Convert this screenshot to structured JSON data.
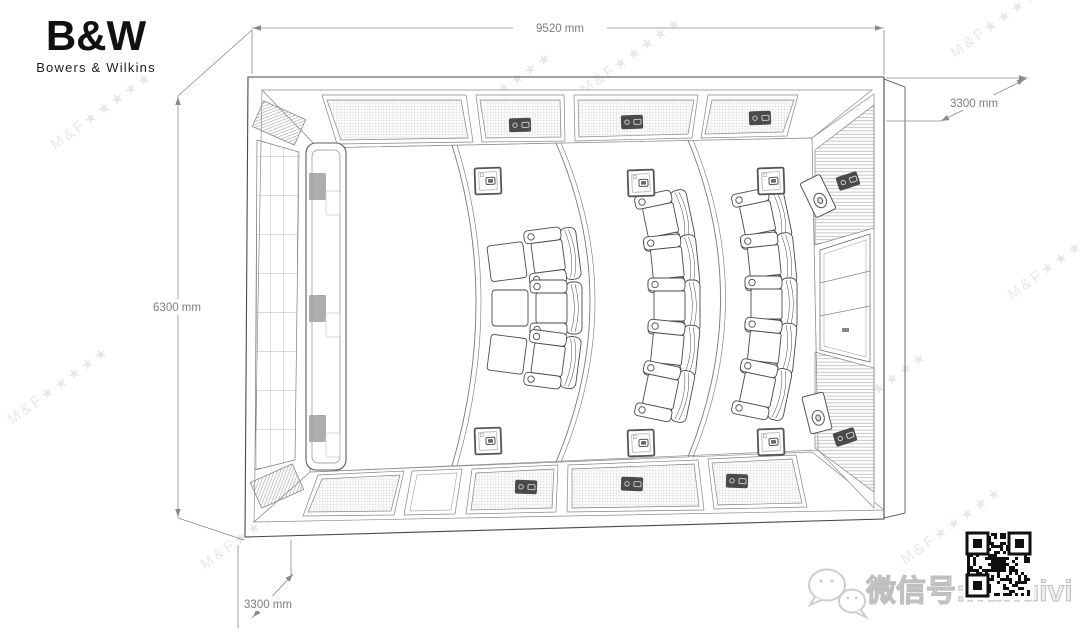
{
  "brand": {
    "logo": "B&W",
    "name": "Bowers & Wilkins"
  },
  "dimensions": {
    "top_width": "9520 mm",
    "left_depth": "6300 mm",
    "right_height": "3300 mm",
    "front_height": "3300 mm"
  },
  "plan": {
    "type": "home-theater-top-view",
    "seating_rows": [
      {
        "name": "front-row",
        "seats": 3,
        "ottomans": 3
      },
      {
        "name": "middle-row",
        "seats": 5
      },
      {
        "name": "back-row",
        "seats": 5
      }
    ],
    "floor_boxes": 6,
    "screen_speakers": 3,
    "surround_speakers": 2
  },
  "watermark": {
    "text": "M&F★★★★★"
  },
  "footer": {
    "wechat_label": "微信号:hdhuivi"
  },
  "qr": {
    "modules": 21,
    "seed": 9
  }
}
